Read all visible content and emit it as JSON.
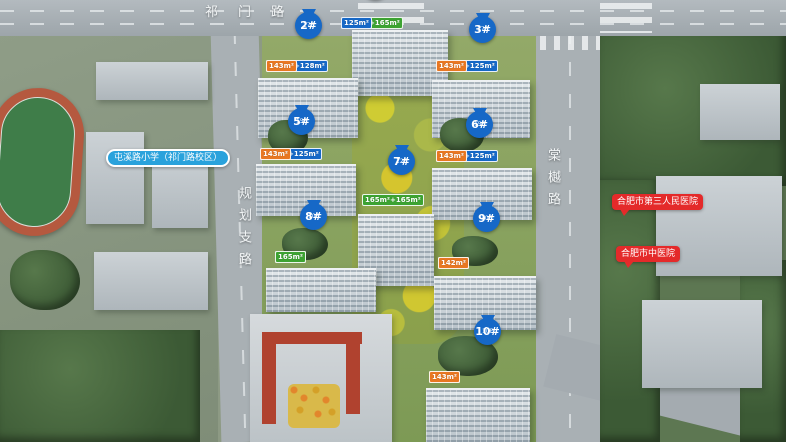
{
  "colors": {
    "pin": "#1668c7",
    "tag_blue": "#1668c7",
    "tag_orange": "#e87722",
    "tag_green": "#3da332",
    "school_label_bg": "#2aa2dc",
    "hospital_label_bg": "#e42a2a"
  },
  "roads": [
    {
      "id": "qimen-road",
      "name": "祁门路",
      "dir": "h",
      "x": 205,
      "y": 1
    },
    {
      "id": "guihua-branch-road",
      "name": "规划支路",
      "dir": "v",
      "x": 234,
      "y": 186
    },
    {
      "id": "tangyue-road",
      "name": "棠樾路",
      "dir": "v",
      "x": 543,
      "y": 148
    }
  ],
  "facilities": [
    {
      "id": "tunxi-road-primary-school",
      "label": "屯溪路小学（祁门路校区）",
      "type": "school",
      "x": 106,
      "y": 149
    },
    {
      "id": "hefei-third-peoples-hospital",
      "label": "合肥市第三人民医院",
      "type": "hospital",
      "x": 612,
      "y": 194
    },
    {
      "id": "hefei-tcm-hospital",
      "label": "合肥市中医院",
      "type": "hospital",
      "x": 616,
      "y": 246
    }
  ],
  "pins": [
    {
      "id": "1",
      "label": "",
      "sub": "",
      "x": 376,
      "y": -27
    },
    {
      "id": "2",
      "label": "2#",
      "sub": "17F",
      "x": 309,
      "y": 12
    },
    {
      "id": "3",
      "label": "3#",
      "sub": "17F",
      "x": 483,
      "y": 16
    },
    {
      "id": "5",
      "label": "5#",
      "sub": "15F",
      "x": 302,
      "y": 108
    },
    {
      "id": "6",
      "label": "6#",
      "sub": "15F",
      "x": 480,
      "y": 111
    },
    {
      "id": "7",
      "label": "7#",
      "sub": "12F",
      "x": 402,
      "y": 148
    },
    {
      "id": "8",
      "label": "8#",
      "sub": "10F",
      "x": 314,
      "y": 203
    },
    {
      "id": "9",
      "label": "9#",
      "sub": "10F",
      "x": 487,
      "y": 205
    },
    {
      "id": "10",
      "label": "10#",
      "sub": "10F",
      "x": 488,
      "y": 318
    }
  ],
  "tag_rows": [
    {
      "building": "1",
      "x": 341,
      "y": 17,
      "tags": [
        {
          "t": "125m²",
          "c": "blue"
        },
        {
          "t": "165m²+165m²",
          "c": "green"
        },
        {
          "t": "125m²",
          "c": "blue"
        }
      ]
    },
    {
      "building": "2",
      "x": 266,
      "y": 60,
      "tags": [
        {
          "t": "143m²",
          "c": "orange"
        },
        {
          "t": "128m²+128m²",
          "c": "blue"
        },
        {
          "t": "143m²",
          "c": "orange"
        }
      ]
    },
    {
      "building": "3",
      "x": 436,
      "y": 60,
      "tags": [
        {
          "t": "143m²",
          "c": "orange"
        },
        {
          "t": "125m²+125m²",
          "c": "blue"
        },
        {
          "t": "143m²",
          "c": "orange"
        }
      ]
    },
    {
      "building": "5",
      "x": 260,
      "y": 148,
      "tags": [
        {
          "t": "143m²",
          "c": "orange"
        },
        {
          "t": "125m²+125m²",
          "c": "blue"
        },
        {
          "t": "143m²",
          "c": "orange"
        }
      ]
    },
    {
      "building": "6",
      "x": 436,
      "y": 150,
      "tags": [
        {
          "t": "143m²",
          "c": "orange"
        },
        {
          "t": "125m²+125m²",
          "c": "blue"
        },
        {
          "t": "143m²",
          "c": "orange"
        }
      ]
    },
    {
      "building": "7",
      "x": 362,
      "y": 194,
      "tags": [
        {
          "t": "165m²+165m²",
          "c": "green"
        }
      ]
    },
    {
      "building": "8",
      "x": 275,
      "y": 251,
      "tags": [
        {
          "t": "165m²",
          "c": "green"
        },
        {
          "t": "165m²",
          "c": "green"
        },
        {
          "t": "165m²",
          "c": "green"
        },
        {
          "t": "165m²",
          "c": "green"
        }
      ]
    },
    {
      "building": "9",
      "x": 438,
      "y": 257,
      "tags": [
        {
          "t": "143m²",
          "c": "orange"
        },
        {
          "t": "121m²",
          "c": "blue"
        },
        {
          "t": "125m²",
          "c": "blue"
        },
        {
          "t": "142m²",
          "c": "orange"
        }
      ]
    },
    {
      "building": "10",
      "x": 429,
      "y": 371,
      "tags": [
        {
          "t": "143m²",
          "c": "orange"
        },
        {
          "t": "143m²",
          "c": "orange"
        },
        {
          "t": "143m²",
          "c": "orange"
        },
        {
          "t": "143m²",
          "c": "orange"
        }
      ]
    }
  ]
}
